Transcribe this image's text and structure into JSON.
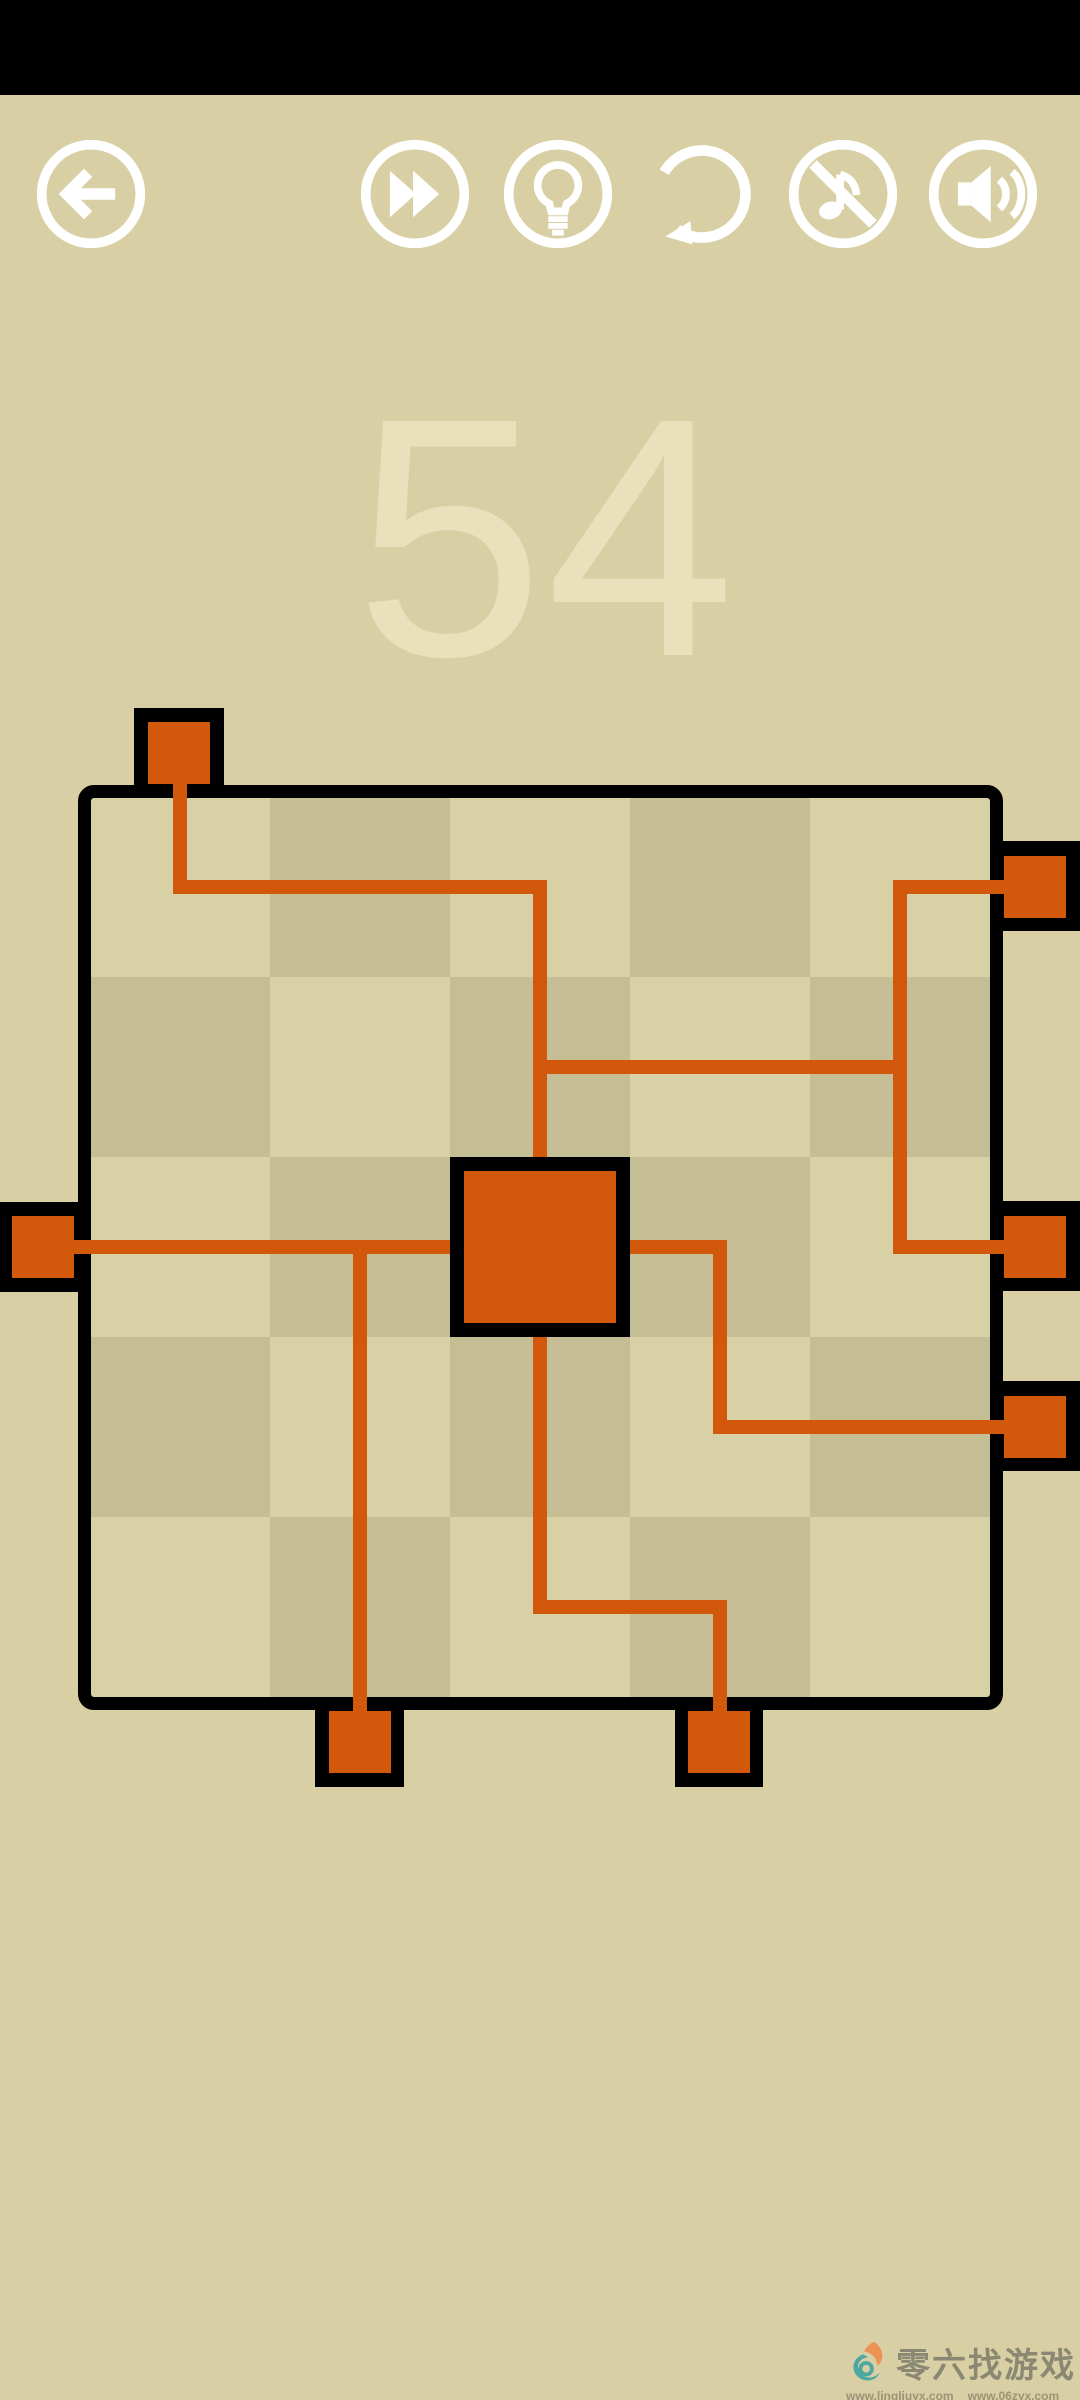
{
  "app": {
    "background_color": "#d8d0a4",
    "statusbar_color": "#000000"
  },
  "toolbar": {
    "icon_color": "#ffffff",
    "buttons": [
      {
        "name": "back",
        "icon": "arrow-left-icon",
        "cx": 91
      },
      {
        "name": "fast-forward",
        "icon": "fast-forward-icon",
        "cx": 415
      },
      {
        "name": "hint",
        "icon": "lightbulb-icon",
        "cx": 558
      },
      {
        "name": "restart",
        "icon": "restart-arrow-icon",
        "cx": 702
      },
      {
        "name": "music-off",
        "icon": "music-note-slash-icon",
        "cx": 843
      },
      {
        "name": "sound-on",
        "icon": "speaker-icon",
        "cx": 983
      }
    ]
  },
  "level": {
    "number": "54",
    "color": "#e9e1bb"
  },
  "board": {
    "x": 78,
    "y": 785,
    "outer": 925,
    "border": 13,
    "interior": {
      "x": 90,
      "y": 797,
      "size": 900
    },
    "rows": 5,
    "cols": 5,
    "cell": 180,
    "colors": {
      "cell_light": "#d9d1a6",
      "cell_dark": "#c5bd94",
      "pipe": "#d2590b",
      "block_border": "#000000"
    },
    "pipes": [
      [
        173,
        780,
        14,
        114
      ],
      [
        173,
        880,
        374,
        14
      ],
      [
        533,
        880,
        14,
        284
      ],
      [
        533,
        1060,
        374,
        14
      ],
      [
        893,
        880,
        14,
        374
      ],
      [
        893,
        880,
        117,
        14
      ],
      [
        893,
        1240,
        117,
        14
      ],
      [
        66,
        1240,
        391,
        14
      ],
      [
        353,
        1240,
        14,
        478
      ],
      [
        620,
        1240,
        107,
        14
      ],
      [
        713,
        1240,
        14,
        194
      ],
      [
        713,
        1420,
        297,
        14
      ],
      [
        533,
        1330,
        14,
        284
      ],
      [
        533,
        1600,
        194,
        14
      ],
      [
        713,
        1600,
        14,
        118
      ]
    ],
    "endpoints": [
      {
        "side": "top",
        "black": [
          134,
          708,
          90,
          90
        ],
        "orange": [
          148,
          722,
          62,
          62
        ]
      },
      {
        "side": "left",
        "black": [
          0,
          1202,
          78,
          90
        ],
        "orange": [
          12,
          1216,
          62,
          62
        ]
      },
      {
        "side": "right",
        "black": [
          990,
          841,
          90,
          90
        ],
        "orange": [
          1004,
          856,
          62,
          62
        ]
      },
      {
        "side": "right",
        "black": [
          990,
          1201,
          90,
          90
        ],
        "orange": [
          1004,
          1216,
          62,
          62
        ]
      },
      {
        "side": "right",
        "black": [
          990,
          1381,
          90,
          90
        ],
        "orange": [
          1004,
          1396,
          62,
          62
        ]
      },
      {
        "side": "bottom",
        "black": [
          315,
          1697,
          89,
          90
        ],
        "orange": [
          329,
          1711,
          62,
          62
        ]
      },
      {
        "side": "bottom",
        "black": [
          675,
          1697,
          88,
          90
        ],
        "orange": [
          688,
          1711,
          62,
          62
        ]
      }
    ],
    "center_block": {
      "black": [
        450,
        1157,
        180,
        180
      ],
      "orange": [
        464,
        1171,
        152,
        152
      ]
    }
  },
  "watermark": {
    "brand": "零六找游戏",
    "urls": [
      "www.lingliuyx.com",
      "www.06zyx.com"
    ],
    "brand_color": "#8a8872",
    "logo_colors": {
      "flame": "#ec9254",
      "swirl": "#4ea7a0"
    }
  }
}
